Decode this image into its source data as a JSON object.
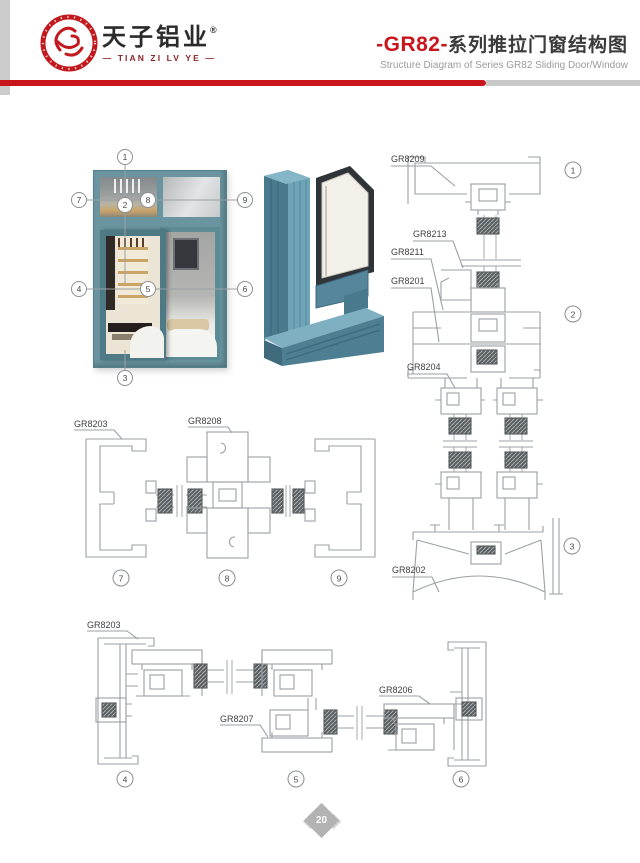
{
  "header": {
    "brand_cn": "天子铝业",
    "brand_reg": "®",
    "brand_en": "— TIAN ZI LV YE —",
    "title_series": "-GR82-",
    "title_cn": "系列推拉门窗结构图",
    "subtitle_en": "Structure Diagram of Series GR82 Sliding Door/Window"
  },
  "colors": {
    "accent_red": "#c9151c",
    "bar_gray": "#c8c8c8",
    "drawing_line_gray": "#9ba0a4",
    "label_text": "#3f3f3f",
    "window_frame_teal": "#6a95a0",
    "render_teal": "#55869b",
    "page_marker_gray": "#b3b3b3"
  },
  "photo_callouts": {
    "c1": "1",
    "c2": "2",
    "c3": "3",
    "c4": "4",
    "c5": "5",
    "c6": "6",
    "c7": "7",
    "c8": "8",
    "c9": "9"
  },
  "vertical_section": {
    "label_top_frame": "GR8209",
    "label_cover": "GR8213",
    "label_transom_upper": "GR8211",
    "label_transom_lower": "GR8201",
    "label_sash_rail": "GR8204",
    "label_sill": "GR8202",
    "callout_top": "1",
    "callout_middle": "2",
    "callout_bottom": "3"
  },
  "mid_section": {
    "label_jamb": "GR8203",
    "label_meeting_stile": "GR8208",
    "callout_left": "7",
    "callout_center": "8",
    "callout_right": "9"
  },
  "bottom_section": {
    "label_jamb": "GR8203",
    "label_interlock": "GR8207",
    "label_sash": "GR8206",
    "callout_left": "4",
    "callout_center": "5",
    "callout_right": "6"
  },
  "footer": {
    "page_number": "20"
  }
}
